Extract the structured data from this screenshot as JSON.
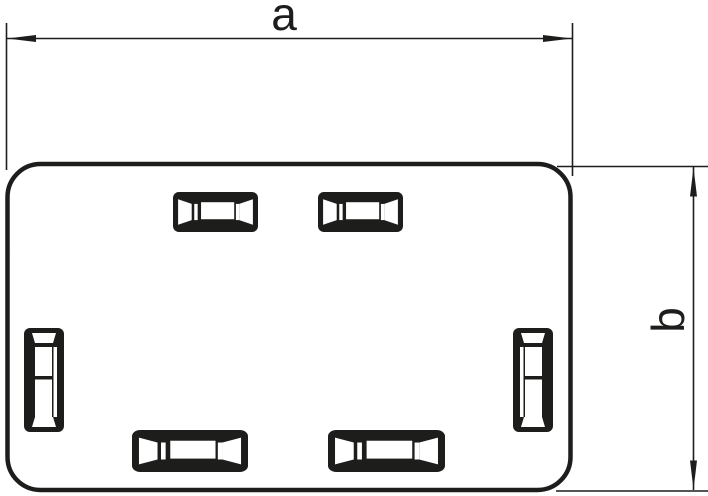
{
  "figure": {
    "kind": "technical-line-drawing",
    "subject": "rectangular cover plate with rounded corners and six knockout slots"
  },
  "colors": {
    "line": "#1d1d1b",
    "paper": "#ffffff"
  },
  "dimensions": {
    "a": {
      "label": "a",
      "axis": "horizontal"
    },
    "b": {
      "label": "b",
      "axis": "vertical"
    }
  },
  "slots": {
    "top": 2,
    "bottom": 2,
    "left": 1,
    "right": 1,
    "total": 6
  }
}
